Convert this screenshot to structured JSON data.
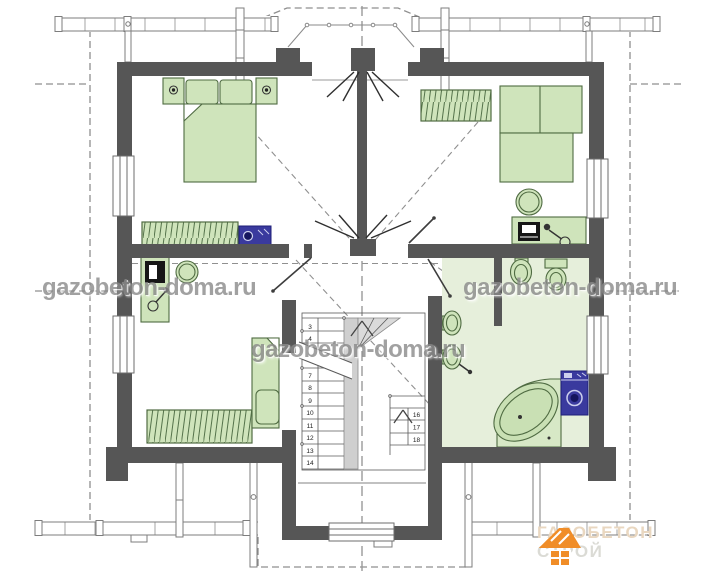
{
  "watermarks": {
    "left": "gazobeton-doma.ru",
    "center": "gazobeton-doma.ru",
    "right": "gazobeton-doma.ru"
  },
  "stairs": {
    "lower_flight_numbers": [
      "3",
      "4",
      "7",
      "8",
      "9",
      "10",
      "11",
      "12",
      "13",
      "14"
    ],
    "upper_flight_numbers": [
      "16",
      "17",
      "18"
    ]
  },
  "logo": {
    "title": "ГАЗОБЕТОН",
    "subtitle": "СТРОЙ"
  },
  "colors": {
    "wall": "#565656",
    "furniture_fill": "#cfe4bb",
    "furniture_stroke": "#4f6b42",
    "bathroom_floor": "#e6efdb",
    "appliance_blue": "#3a3a9e",
    "stair_shade": "#cfcfcf",
    "dashed_gray": "#8f8f8f",
    "watermark_gray": "#8a8a8a",
    "logo_orange": "#f08d28",
    "logo_title_color": "#e9d7c0",
    "logo_subtitle_color": "#dbdbd5"
  }
}
